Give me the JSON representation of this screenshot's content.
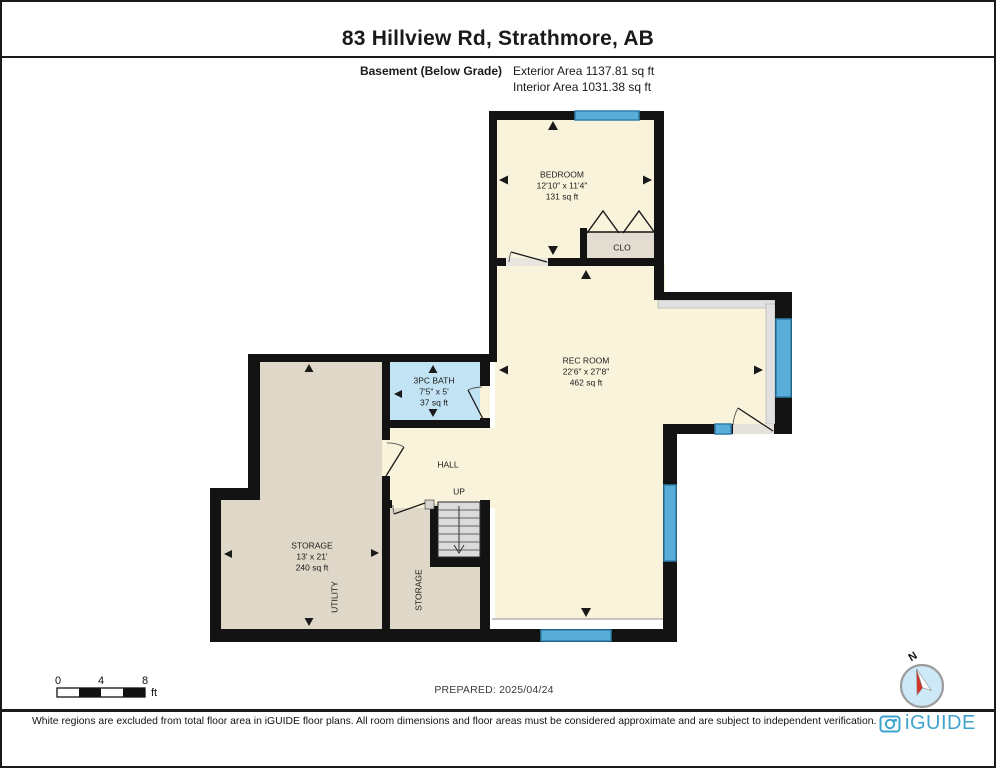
{
  "header": {
    "title": "83 Hillview Rd, Strathmore, AB",
    "floor_label": "Basement (Below Grade)",
    "exterior_area": "Exterior Area 1137.81 sq ft",
    "interior_area": "Interior Area 1031.38 sq ft"
  },
  "rooms": {
    "bedroom": {
      "name": "BEDROOM",
      "dims": "12'10\" x 11'4\"",
      "area": "131 sq ft"
    },
    "closet": {
      "name": "CLO"
    },
    "rec_room": {
      "name": "REC ROOM",
      "dims": "22'6\" x 27'8\"",
      "area": "462 sq ft"
    },
    "bath": {
      "name": "3PC BATH",
      "dims": "7'5\" x 5'",
      "area": "37 sq ft"
    },
    "hall": {
      "name": "HALL"
    },
    "stairs": {
      "direction": "UP"
    },
    "storage": {
      "name": "STORAGE",
      "dims": "13' x 21'",
      "area": "240 sq ft"
    },
    "utility": {
      "name": "UTILITY"
    },
    "storage2": {
      "name": "STORAGE"
    }
  },
  "scale_bar": {
    "labels": [
      "0",
      "4",
      "8"
    ],
    "unit": "ft"
  },
  "compass": {
    "north": "N"
  },
  "footer": {
    "prepared": "PREPARED: 2025/04/24",
    "disclaimer": "White regions are excluded from total floor area in iGUIDE floor plans. All room dimensions and floor areas must be considered approximate and are subject to independent verification.",
    "logo": "iGUIDE"
  },
  "colors": {
    "room_fill": "#FAF3DC",
    "storage_fill": "#DFD7C7",
    "bath_fill": "#C2E3F3",
    "closet_fill": "#E2DCD1",
    "window_blue": "#58AED8",
    "wall_black": "#131313",
    "logo_blue": "#3FA3CE",
    "compass_fill": "#CDE8F6",
    "needle_red": "#D63227"
  }
}
